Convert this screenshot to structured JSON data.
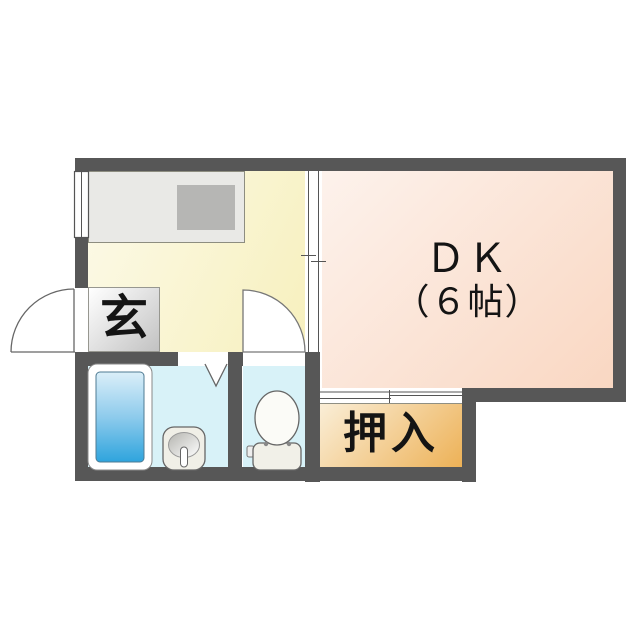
{
  "floor_plan": {
    "rooms": {
      "dk": {
        "label": "ＤＫ",
        "size": "（６帖）"
      },
      "genkan": {
        "label": "玄"
      },
      "closet": {
        "label": "押入"
      },
      "kitchen": {
        "label": ""
      },
      "washroom": {
        "label": ""
      },
      "toilet_room": {
        "label": ""
      }
    },
    "fixtures": [
      "kitchen-counter",
      "stove-top",
      "window-symbol",
      "entrance-door-arc",
      "interior-door-arc",
      "sliding-door-kitchen-dk",
      "sliding-door-closet",
      "folding-door-symbol",
      "bathtub",
      "wash-basin",
      "toilet"
    ],
    "colors": {
      "wall": "#575757",
      "kitchen_floor": "#f8f2c6",
      "dk_floor": "#fbdcc9",
      "closet": "#efb763",
      "wet_area_floor": "#d8f2f8",
      "bathtub_water": "#2ea4dd",
      "genkan_step": "#c2c2c2",
      "counter": "#e9e9e6",
      "background": "#ffffff"
    }
  }
}
